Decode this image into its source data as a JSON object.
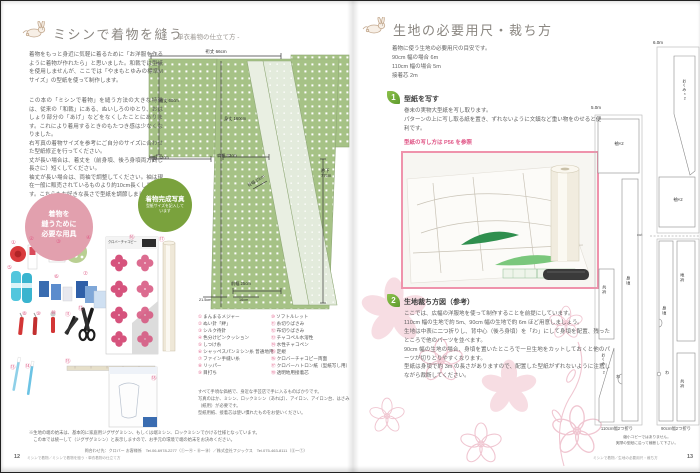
{
  "left_page": {
    "title": "ミシンで着物を縫う",
    "subtitle": "‐ 単衣着物の仕立て方 ‐",
    "paragraphs": {
      "intro": "着物をもっと身近に気軽に着るために「お洋服を作るように着物が作れたら」と思いました。和裁では型紙を使用しませんが、ここでは「やまもとゆみの標準Mサイズ」の型紙を使って制作します。",
      "p1": "この本の「ミシンで着物」を縫う方法の大きな特徴は、従来の「和裁」にある、ぬいしろのゆとり、おはしょり部分の「あげ」などをなくしたことにあります。これにより着用するときのもたつき感は少なくなりました。",
      "p2": "右写真の着物サイズを参考にご自分のサイズに合わせた型紙修正を行ってください。",
      "p3": "丈が長い場合は、着丈を（前身頃、後ろ身頃両方同じ長さに）短くしてください。",
      "p4": "袖丈が長い場合は、両袖で調整してください。袖は現在一般に販売されているものより約10cm長くしています。こちらもお好きな長さで型紙を調節しましょう。"
    },
    "pink_circle": {
      "line1": "着物を",
      "line2": "縫うために",
      "line3": "必要な用具"
    },
    "green_circle": {
      "title": "着物完成写真",
      "sub": "型紙サイズを記入しています"
    },
    "kimono": {
      "yukitake": "裄丈 66cm",
      "sodetake": "袖丈 60cm",
      "mitake": "身丈 160cm",
      "sodehaba": "袖幅 33cm",
      "katahaba": "肩幅 33cm",
      "okumihaba": "衽幅 15cm",
      "maehaba": "前幅 25cm",
      "erishita": "衿下 77cm",
      "hem_left": "21.5cm",
      "hem_right": "16cm"
    },
    "tools": [
      {
        "num": "①",
        "label": "まんまるメジャー"
      },
      {
        "num": "②",
        "label": "ぬい針「絆」"
      },
      {
        "num": "③",
        "label": "シルク待針"
      },
      {
        "num": "④",
        "label": "色分けピンクッション"
      },
      {
        "num": "⑤",
        "label": "しつけ糸"
      },
      {
        "num": "⑥",
        "label": "シャッペスパンミシン糸 普通地用"
      },
      {
        "num": "⑦",
        "label": "ファイン手縫い糸"
      },
      {
        "num": "⑧",
        "label": "リッパー"
      },
      {
        "num": "⑨",
        "label": "目打ち"
      },
      {
        "num": "⑩",
        "label": "ソフトルレット"
      },
      {
        "num": "⑪",
        "label": "糸切りばさみ"
      },
      {
        "num": "⑫",
        "label": "布切りばさみ"
      },
      {
        "num": "⑬",
        "label": "チャコペル水溶性"
      },
      {
        "num": "⑭",
        "label": "水性チャコペン"
      },
      {
        "num": "⑮",
        "label": "定規"
      },
      {
        "num": "⑯",
        "label": "クロバーチャコピー両面"
      },
      {
        "num": "⑰",
        "label": "クロバーハトロン紙（型紙写し用）"
      },
      {
        "num": "⑱",
        "label": "透明地用接着芯"
      }
    ],
    "chacopy_label": "クロバーチャコピー",
    "tools_note": {
      "l1": "すべて手頃な価格で、身近な手芸店で手に入るものばかりです。",
      "l2": "写真のほか、ミシン、ロックミシン（あれば）、アイロン、アイロン台、はさみ（紙用）が必要です。",
      "l3": "型紙用紙、接着芯は使い慣れたものをお使いください。"
    },
    "bottom_note": {
      "l1": "※生地の端の始末は、基本的に家庭用ジグザグミシン、もしくは端ミシン、ロックミシンでかける仕様となっています。",
      "l2": "　この本では統一して（ジグザグミシン）と表示しますので、お手元の環境で端の始末をお決めください。"
    },
    "contact": "問合わせ先：クロバー お客様係　Tel.06-6978-2277（①～④・⑧～⑱）／株式会社フジックス　Tel.075-463-8111（⑤～⑦）",
    "footer": {
      "page": "12",
      "text": "ミシンで着物／ミシンで着物を縫う・単衣着物の仕立て方"
    }
  },
  "right_page": {
    "title": "生地の必要用尺・裁ち方",
    "intro": [
      "着物に使う生地の必要用尺の目安です。",
      "90cm 幅の場合 6m",
      "110cm 幅の場合 5m",
      "接着芯 2m"
    ],
    "section1": {
      "num": "1",
      "heading": "型紙を写す",
      "p1": "巻末の実物大型紙を写し取ります。",
      "p2": "パターンの上に写し取る紙を置き、ずれないように文鎮など重い物をのせると便利です。",
      "ref": "型紙の写し方は P56 を参照"
    },
    "section2": {
      "num": "2",
      "heading": "生地裁ち方図（参考）",
      "p1": "ここでは、広幅の洋服地を使って制作することを前提にしています。",
      "p2": "110cm 幅の生地で約 5m、90cm 幅の生地で約 6m ほど用意しましょう。",
      "p3": "生地は中表に二つ折りし、背中心（後ろ身頃）を「わ」にして身頃を配置、残ったところで他のパーツを並べます。",
      "p4": "90cm 幅の生地の場合、身頃を置いたところで一旦生地をカットしておくと他のパーツが切りとりやすくなります。",
      "p5": "型紙は身頃で約 3m の長さがありますので、配置した型紙がずれないように注意しながら裁断してください。"
    },
    "diagrams": {
      "d110": {
        "length": "5.0m",
        "caption": "110cm幅2つ折り",
        "sode": "袖×2",
        "migoro": "身頃",
        "tomoeri": "共衿",
        "okumi": "おくみ×2",
        "wa": "わ"
      },
      "d90": {
        "length": "6.0m",
        "caption": "90cm幅2つ折り",
        "okumi": "おくみ×2",
        "sode": "袖×2",
        "cut": "cut",
        "migoro": "身頃",
        "jieri": "地衿",
        "tomoeri": "共衿",
        "wa": "わ"
      },
      "note1": "縮小コピーではありません。",
      "note2": "実際の型紙に沿って裁断して下さい。"
    },
    "footer": {
      "text": "ミシンで着物／生地の必要用尺・裁ち方",
      "page": "13"
    }
  },
  "colors": {
    "accent_pink": "#e0608a",
    "photo_border": "#ef93ac",
    "kimono_green": "#a6c286",
    "circle_pink": "#e2a0ae",
    "circle_green": "#7aa23d",
    "leaf_green": "#6aab3a"
  }
}
